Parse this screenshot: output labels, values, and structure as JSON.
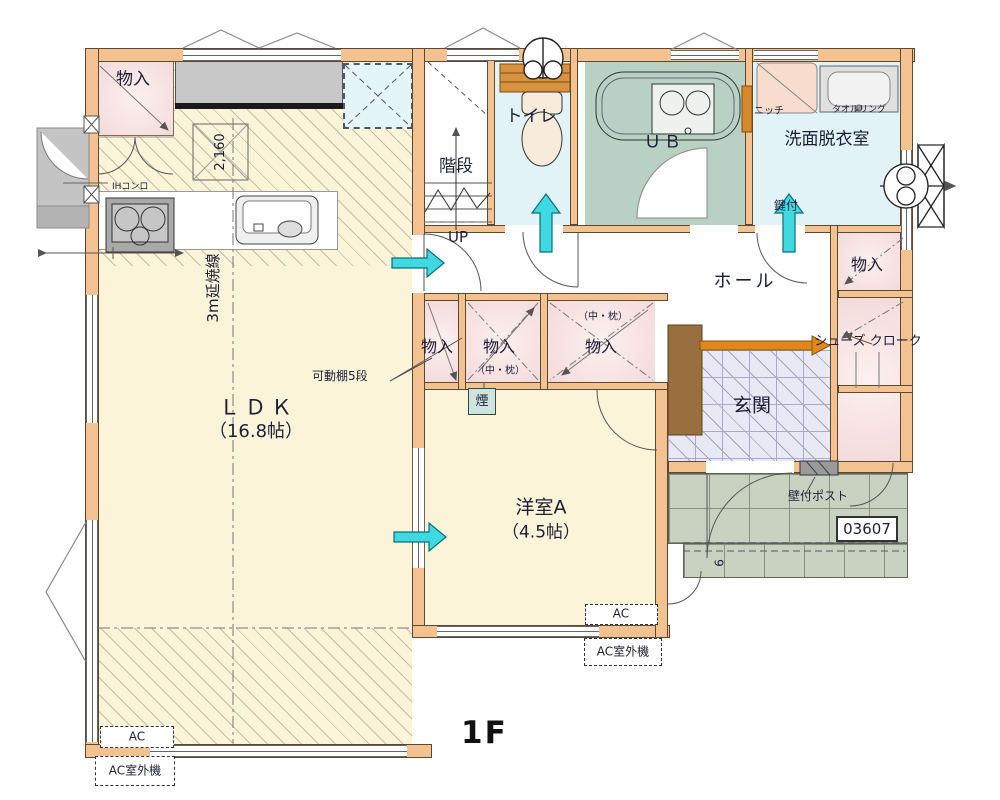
{
  "plan": {
    "floor_label": "1F",
    "drawing_number": "03607",
    "porch_step_count": "9"
  },
  "rooms": {
    "ldk": {
      "name": "ＬＤＫ",
      "size": "（16.8帖）"
    },
    "western_a": {
      "name": "洋室A",
      "size": "（4.5帖）"
    },
    "stairs": {
      "name": "階段",
      "direction": "UP"
    },
    "toilet": {
      "name": "トイレ"
    },
    "bath": {
      "name": "ＵＢ"
    },
    "washroom": {
      "name": "洗面脱衣室"
    },
    "hall": {
      "name": "ホール"
    },
    "entrance": {
      "name": "玄関"
    },
    "shoes_closet": {
      "name": "シューズ クローク"
    }
  },
  "closets": {
    "kitchen_storage": "物入",
    "center_a": "物入",
    "center_b": "物入",
    "center_b_note": "（中・枕）",
    "center_c": "物入",
    "center_c_note": "（中・枕）",
    "hall_storage": "物入"
  },
  "annotations": {
    "ih_stove": "IHコンロ",
    "counter_dimension": "2,160",
    "fire_spread_line": "3m延焼線",
    "movable_shelf": "可動棚5段",
    "smoke_detector": "煙",
    "niche": "ニッチ",
    "towel_ring": "タオルリング",
    "lockable": "鍵付",
    "wall_mounted_post": "壁付ポスト",
    "ac_unit": "AC",
    "ac_outdoor_unit": "AC室外機"
  },
  "colors": {
    "wall": "#f4c291",
    "ldk_floor": "#fbf4d9",
    "closet_pink": "#f7e3e3",
    "wet_area_cyan": "#e1f3f6",
    "bath_teal": "#b9d0c5",
    "entrance_tile": "#e9e8f5",
    "porch_tile": "#c9d2c0",
    "flow_arrow": "#3fd9e2",
    "accent_orange": "#e0881c"
  }
}
